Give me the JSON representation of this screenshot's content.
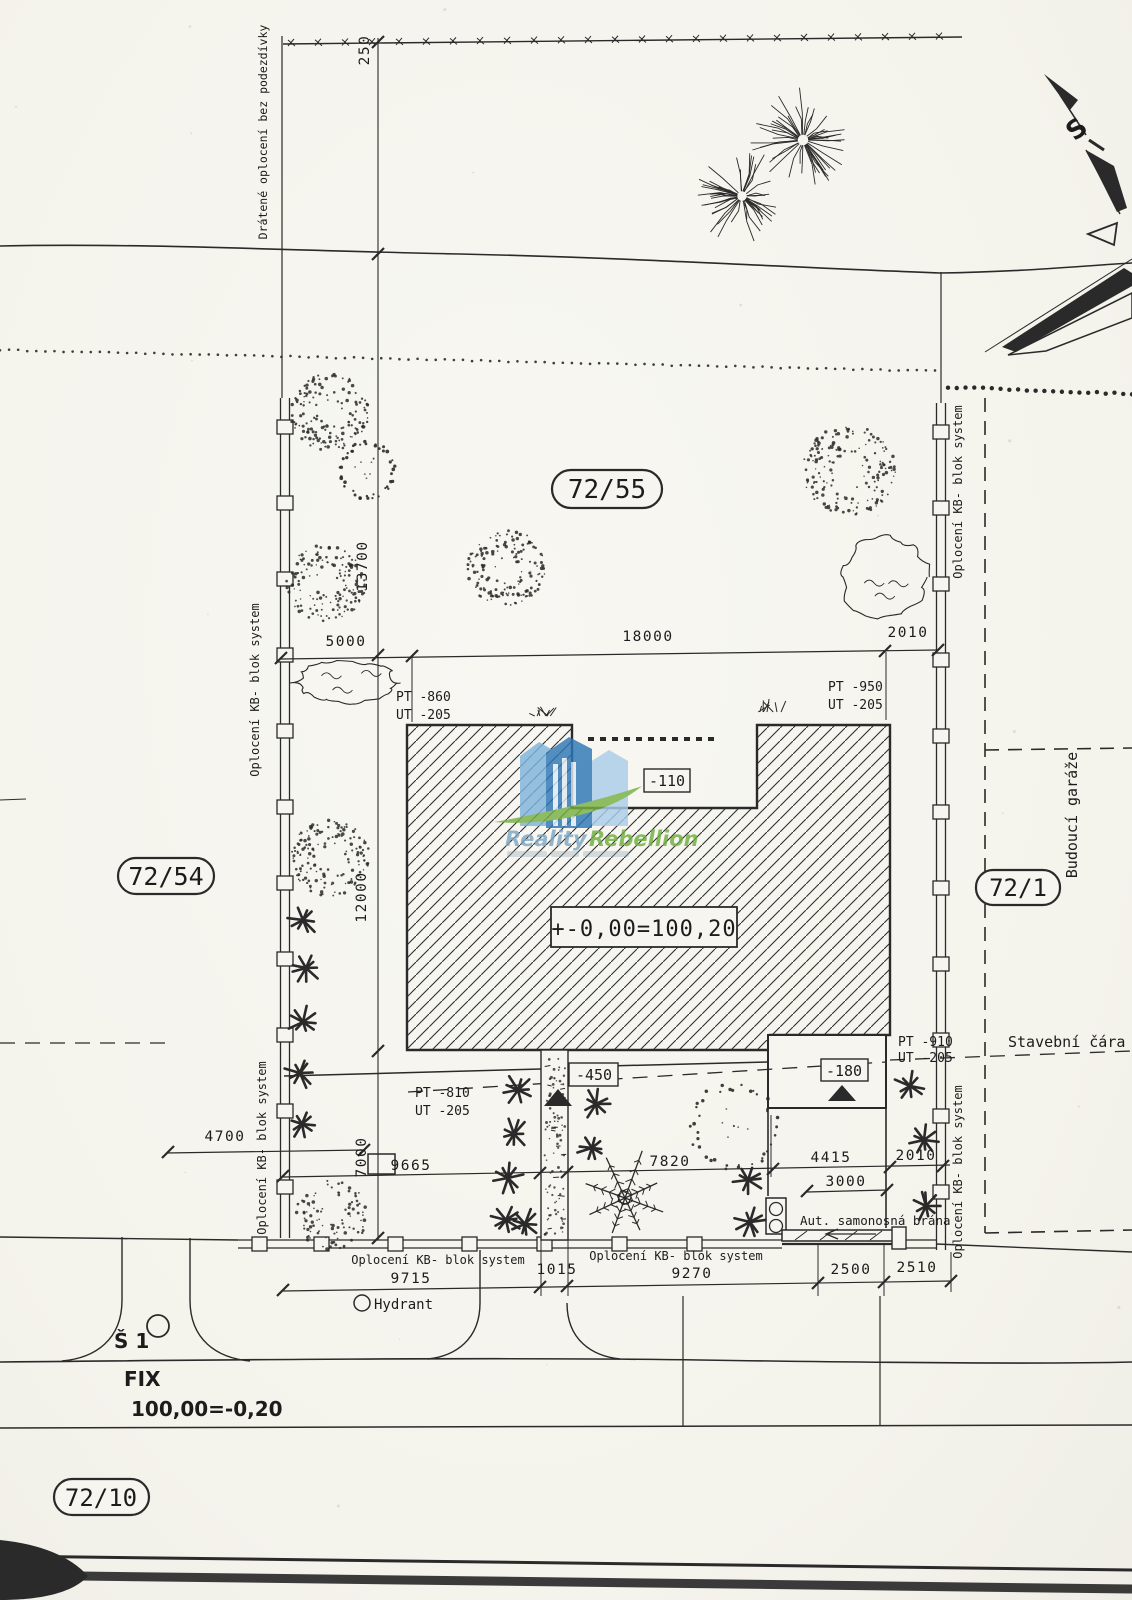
{
  "colors": {
    "ink": "#2a2a2a",
    "paper": "#f6f5f0",
    "wm_blue": "#2e77b5",
    "wm_blue_light": "#7fb4dc",
    "wm_blue_pale": "#a9cde9",
    "wm_green": "#76b043",
    "wm_text_blue": "#7ea7c4",
    "wm_text_green": "#6faf3f"
  },
  "north": {
    "label": "S"
  },
  "parcels": {
    "top": "72/55",
    "left": "72/54",
    "right": "72/1",
    "bottom": "72/10"
  },
  "fences": {
    "wire": "Drátené oplocení bez podezdívky",
    "kb": "Oplocení KB- blok system"
  },
  "building": {
    "zero_level": "+-0,00=100,20",
    "terrace_level": "-110",
    "entry_level": "-450",
    "garage_level": "-180"
  },
  "levels": {
    "pt_tl": "PT -860",
    "ut_tl": "UT -205",
    "pt_tr": "PT -950",
    "ut_tr": "UT -205",
    "pt_bl": "PT -810",
    "ut_bl": "UT -205",
    "pt_br": "PT -910",
    "ut_br": "UT -205"
  },
  "dims": {
    "top_offset": "250",
    "front_left": "5000",
    "front_main": "18000",
    "front_right": "2010",
    "depth_upper": "13700",
    "depth_mid": "12000",
    "depth_lower": "7000",
    "side_offset": "4700",
    "rear_1": "9665",
    "rear_2": "7820",
    "rear_3": "4415",
    "rear_4": "2010",
    "gate_width": "3000",
    "street_1": "9715",
    "street_2": "1015",
    "street_3": "9270",
    "street_4": "2500",
    "street_5": "2510"
  },
  "labels": {
    "building_line": "Stavební čára",
    "future_garages": "Budoucí garáže",
    "gate": "Aut. samonosná brána",
    "hydrant": "Hydrant",
    "manhole": "Š 1",
    "fix": "FIX",
    "fix_level": "100,00=-0,20"
  },
  "watermark": {
    "word1": "Reality",
    "word2": "Rebellion"
  }
}
